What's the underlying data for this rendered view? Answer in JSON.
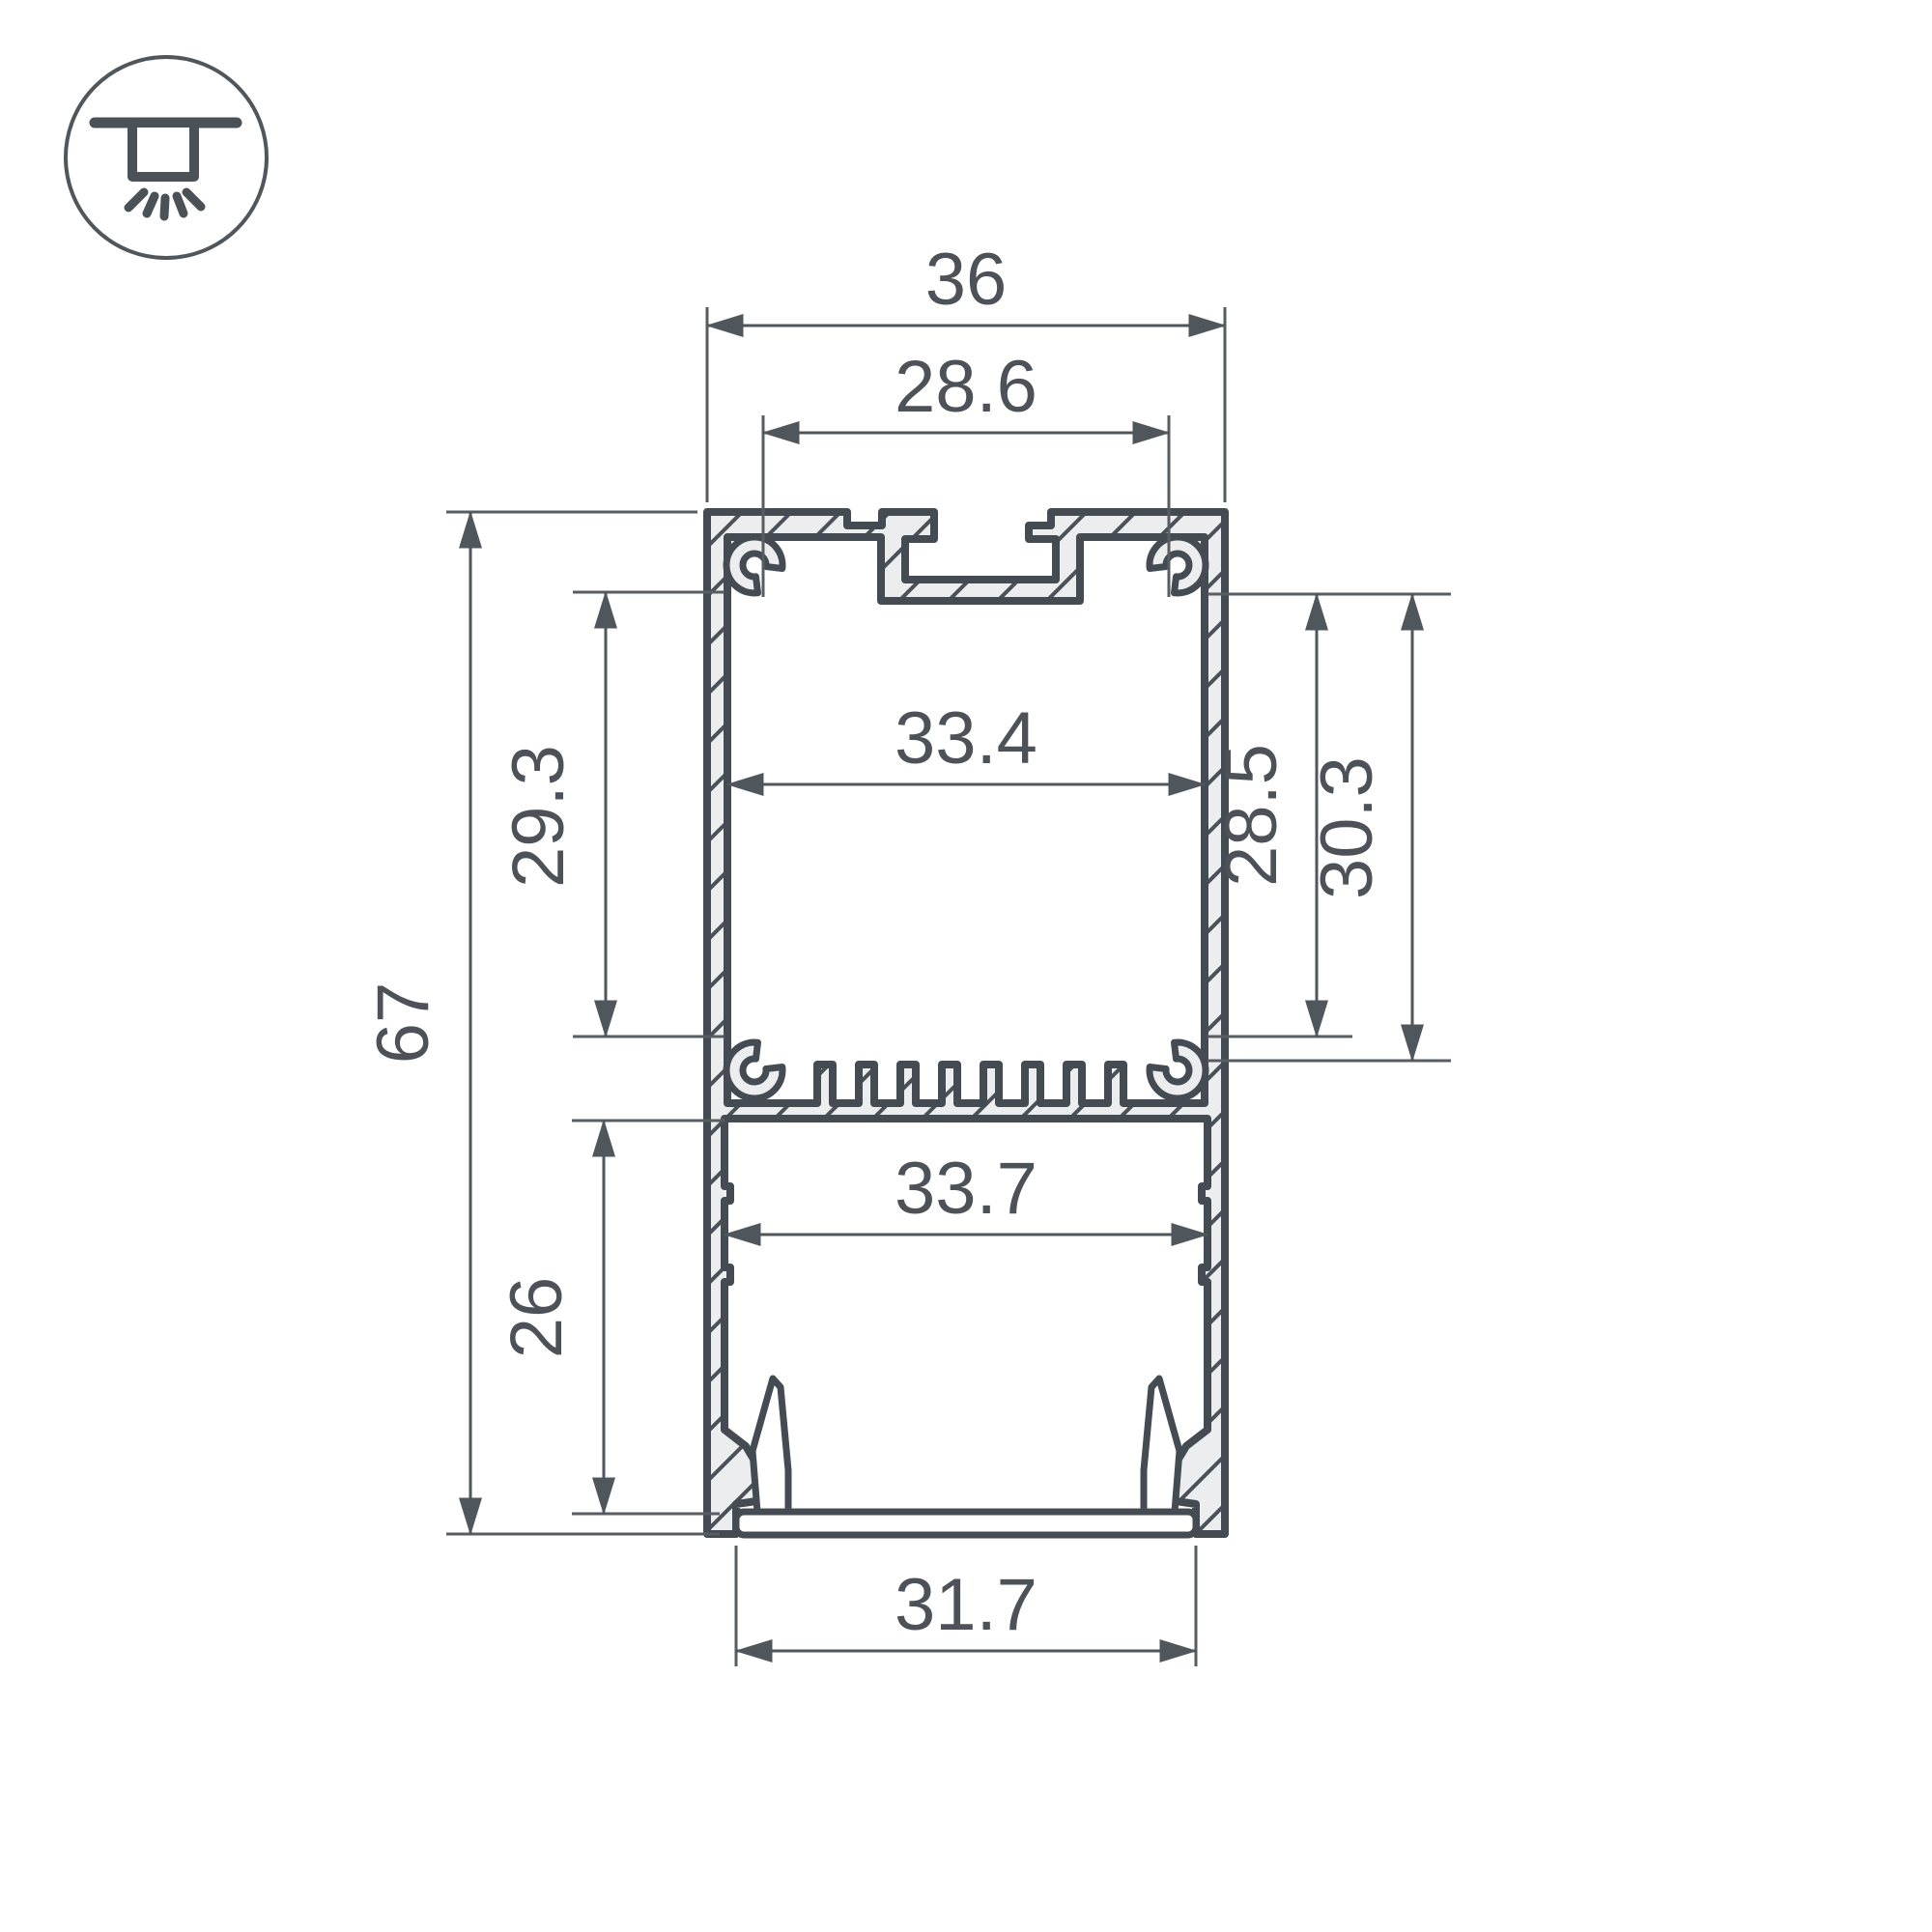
{
  "drawing": {
    "type": "profile-cross-section",
    "icon": "surface-mounted-luminaire-icon",
    "units_shown": false
  },
  "dimensions": {
    "top_width": "36",
    "mount_slot_width": "28.6",
    "upper_inner_width": "33.4",
    "upper_inner_height": "29.3",
    "total_height": "67",
    "right_inner_height_a": "28.5",
    "right_inner_height_b": "30.3",
    "lower_inner_height": "26",
    "lower_inner_width": "33.7",
    "bottom_opening_width": "31.7"
  },
  "colors": {
    "background": "#FFFFFF",
    "outline": "#454B52",
    "metal_fill": "#ECEDEE",
    "hatch_line": "#4A5158",
    "dimension_line": "#4F565C",
    "text": "#4C5258"
  }
}
